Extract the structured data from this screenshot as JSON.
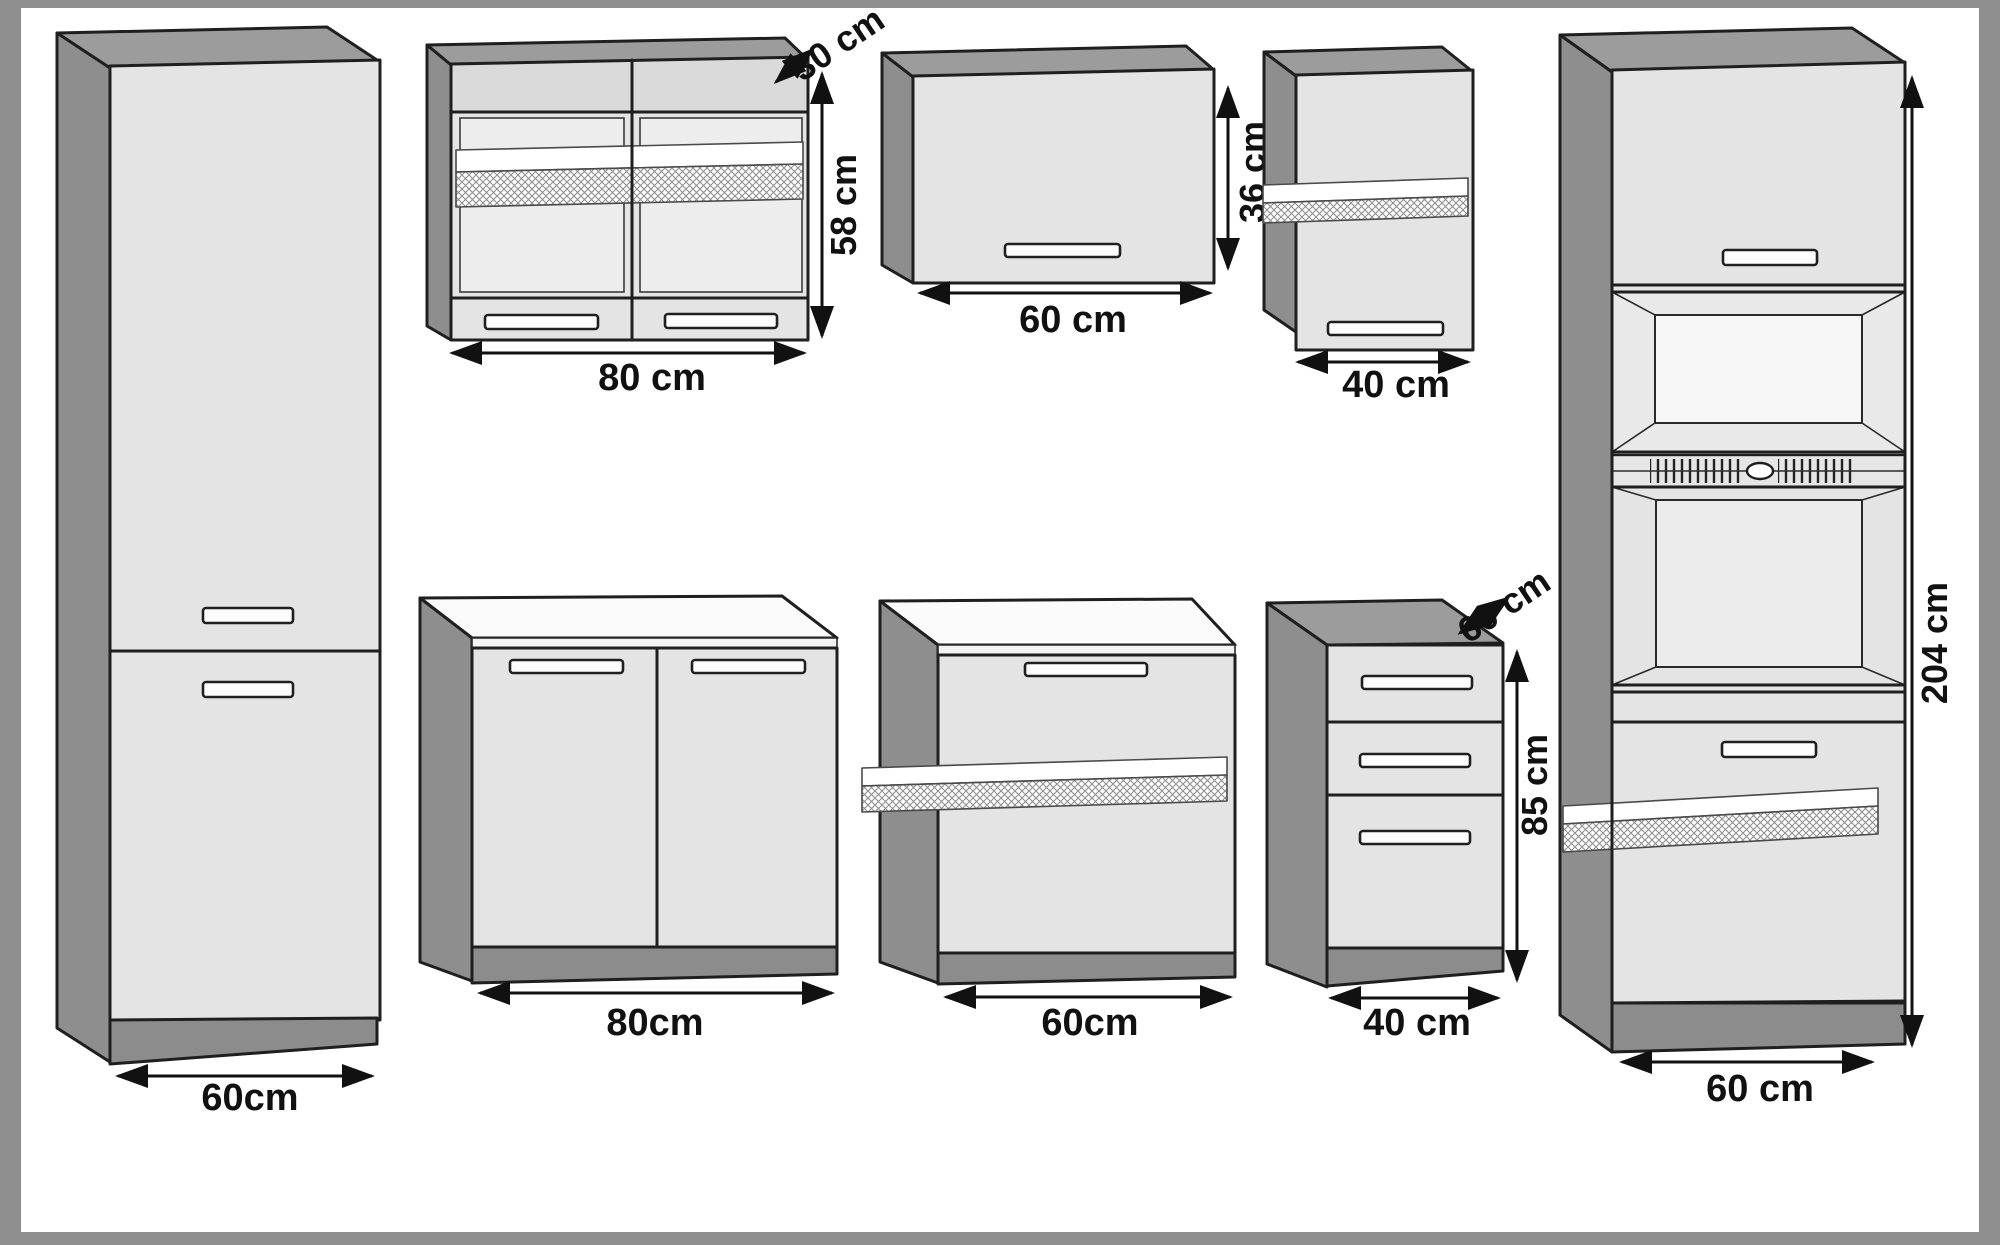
{
  "palette": {
    "frame": "#8f8f8f",
    "background": "#ffffff",
    "cabinet_side": "#8e8e8e",
    "cabinet_top": "#9c9c9c",
    "cabinet_front": "#e4e4e4",
    "cabinet_front_dark": "#dadada",
    "cabinet_front_light": "#ededed",
    "plinth": "#8c8c8c",
    "worktop": "#fbfbfb",
    "worktop_edge": "#f3f3f3",
    "outline": "#1f1f1f",
    "dimension": "#111111",
    "niche": "#f7f7f7",
    "niche_wall": "#e9e9e9",
    "vent": "#e6e6e6"
  },
  "dimensions": {
    "tall_left_width": "60cm",
    "wall_80_depth": "30 cm",
    "wall_80_height": "58 cm",
    "wall_80_width": "80 cm",
    "wall_60_height": "36 cm",
    "wall_60_width": "60 cm",
    "wall_40_width": "40 cm",
    "base_80_width": "80cm",
    "base_60_width": "60cm",
    "drawer_unit_depth": "60 cm",
    "drawer_unit_height": "85 cm",
    "drawer_unit_width": "40 cm",
    "oven_tall_height": "204 cm",
    "oven_tall_width": "60 cm"
  }
}
